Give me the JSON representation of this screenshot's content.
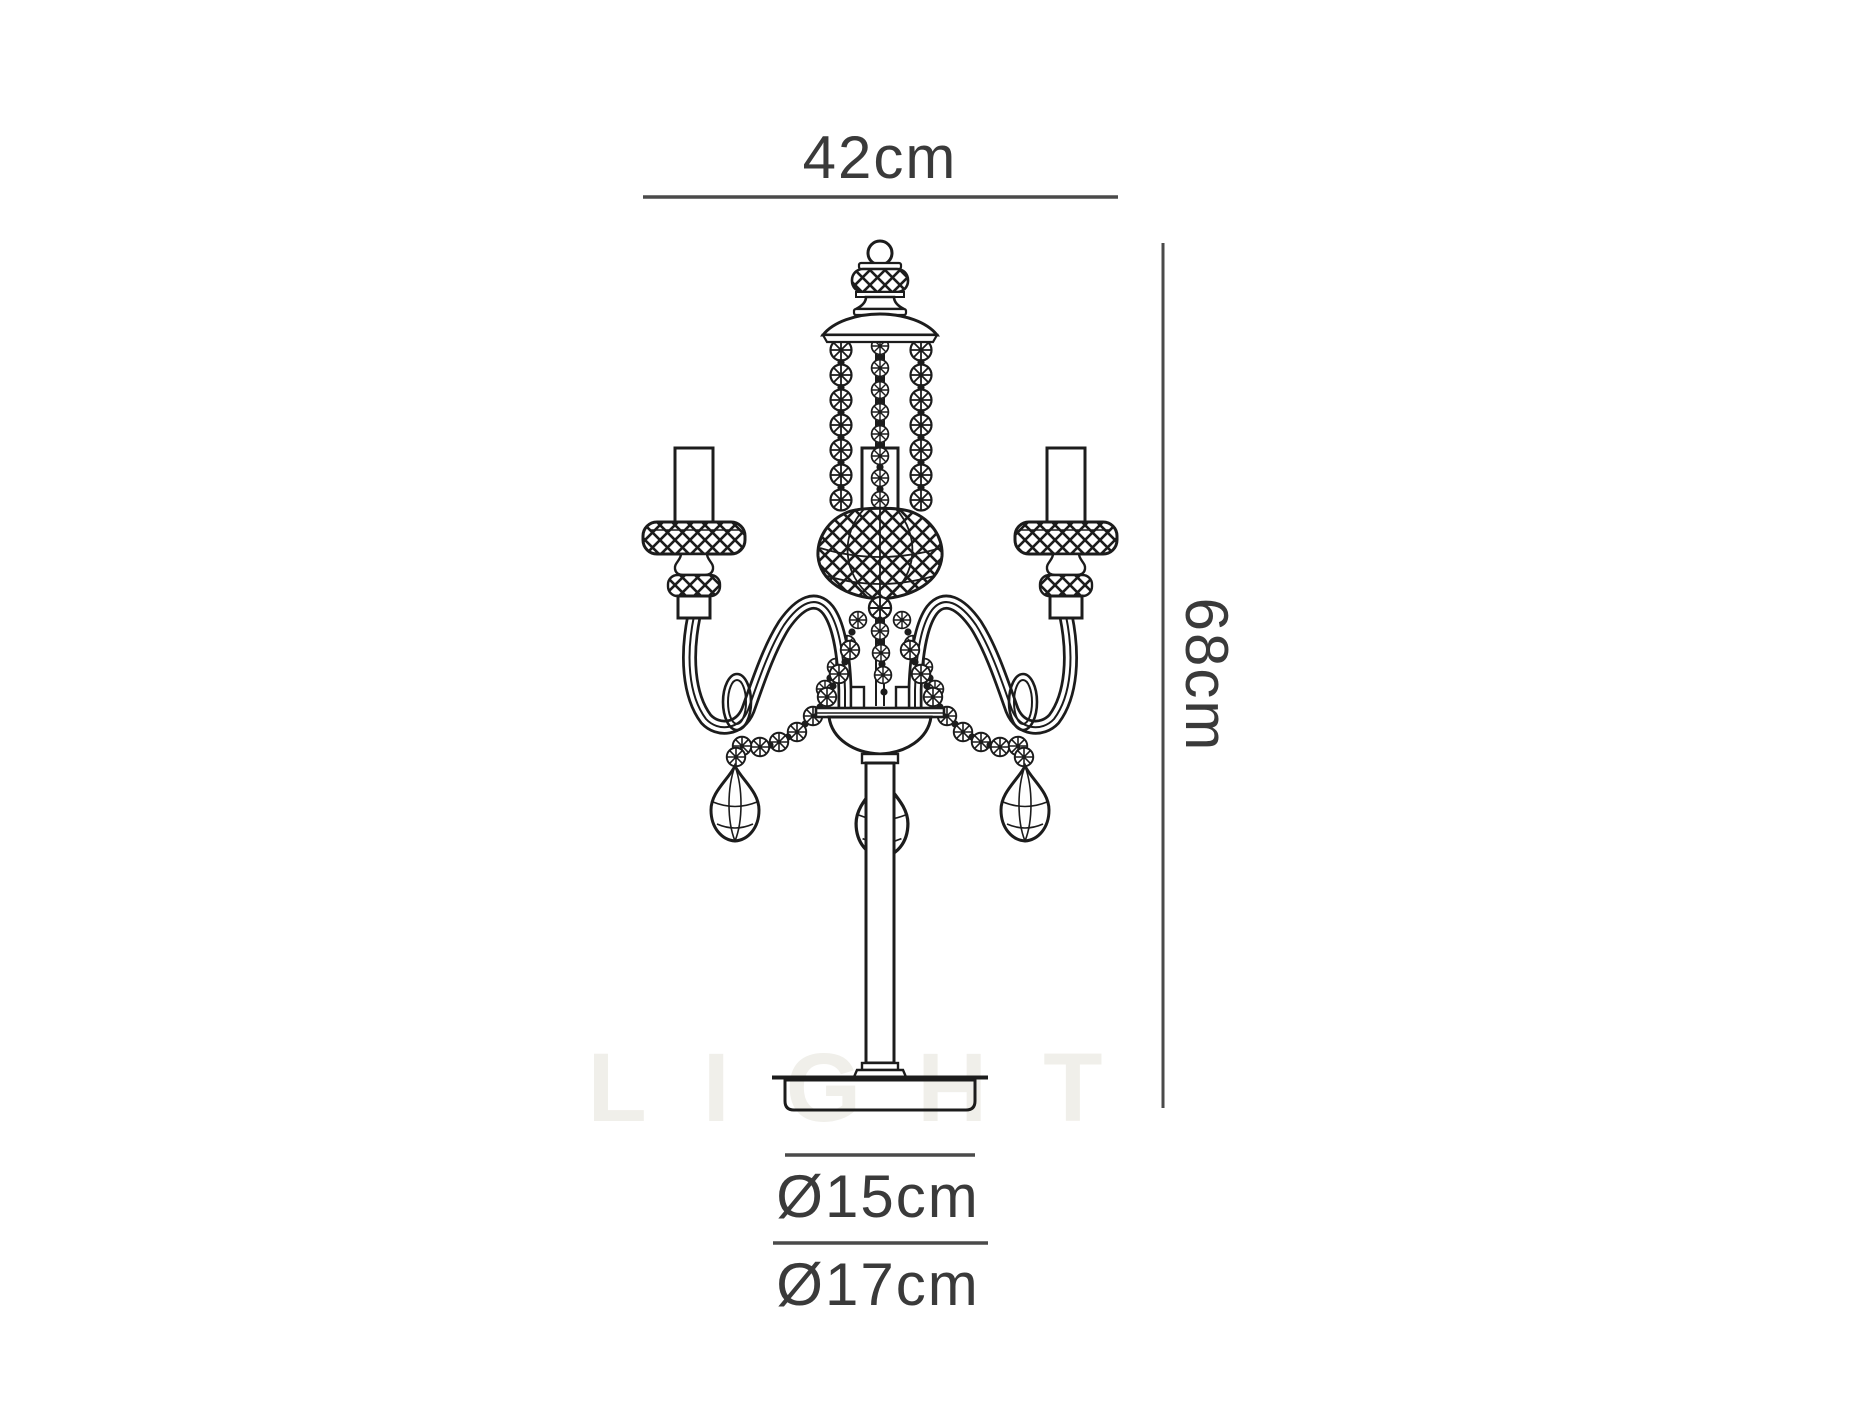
{
  "page": {
    "background_color": "#ffffff",
    "content_type": "product dimension diagram",
    "subject": "3-arm crystal candelabra table lamp, technical line drawing"
  },
  "watermark": {
    "text": "LIGHT",
    "color": "#f0efea"
  },
  "drawing": {
    "line_color": "#1f1f1f",
    "fill_color": "#ffffff",
    "parts": [
      "finial-ball",
      "crystal-knob",
      "canopy",
      "bead-chains",
      "link-chain",
      "crystal-basket",
      "candle-tubes",
      "crosshatched-bobeches",
      "scroll-arms",
      "arm-rings",
      "bead-swags",
      "teardrop-pendants",
      "bowl",
      "stem",
      "round-base"
    ]
  },
  "dimensions": {
    "text_color": "#3a3a3a",
    "line_color": "#4a4a4a",
    "width": {
      "label": "42cm",
      "value_cm": 42,
      "orientation": "horizontal"
    },
    "height": {
      "label": "68cm",
      "value_cm": 68,
      "orientation": "vertical"
    },
    "diameter_inner": {
      "label": "Ø15cm",
      "value_cm": 15
    },
    "diameter_outer": {
      "label": "Ø17cm",
      "value_cm": 17
    }
  }
}
